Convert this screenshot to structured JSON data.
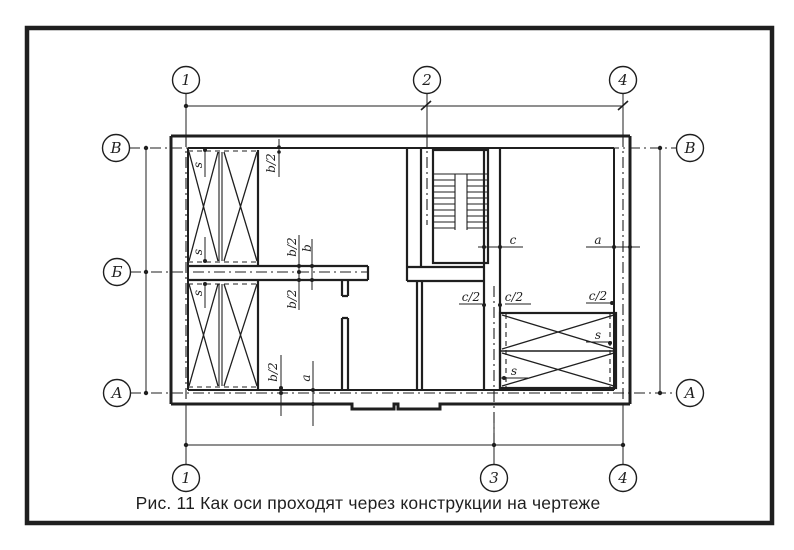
{
  "figure": {
    "caption": "Рис. 11 Как оси проходят через конструкции на чертеже"
  },
  "axis_markers": {
    "top": [
      "1",
      "2",
      "4"
    ],
    "bottom": [
      "1",
      "3",
      "4"
    ],
    "left": [
      "В",
      "Б",
      "А"
    ],
    "right": [
      "В",
      "А"
    ]
  },
  "dimension_labels": {
    "s": "s",
    "half_b": "b/2",
    "b": "b",
    "a": "a",
    "c": "c",
    "half_c": "c/2"
  },
  "colors": {
    "ink": "#1f1f1f",
    "paper": "#ffffff"
  }
}
